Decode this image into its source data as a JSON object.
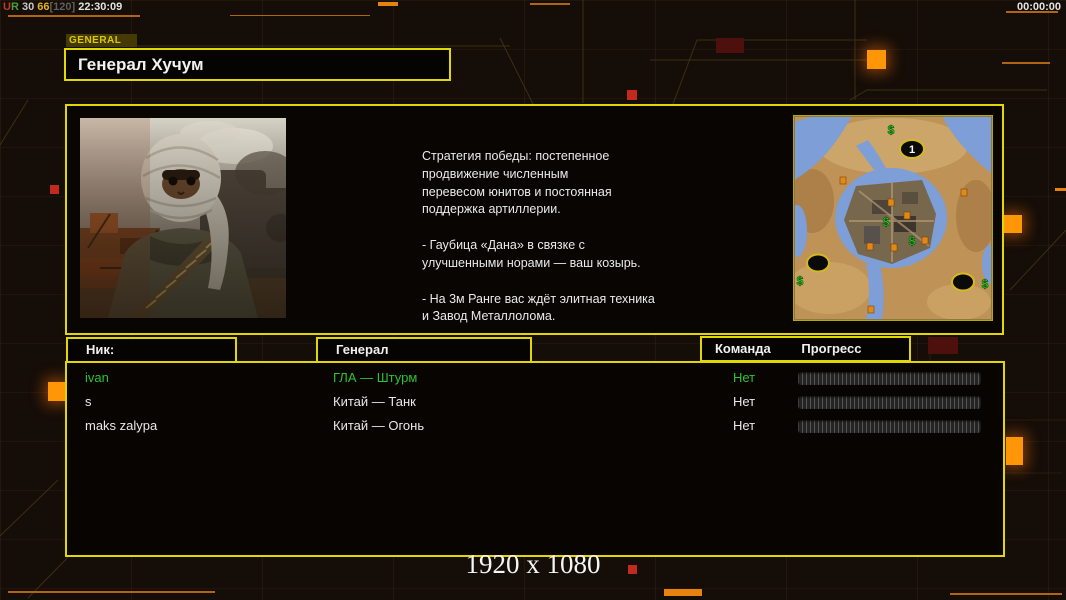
{
  "statusbar": {
    "segments": [
      {
        "text": "U",
        "color": "#c0392b"
      },
      {
        "text": "R",
        "color": "#45a035"
      },
      {
        "text": " 30 ",
        "color": "#c8c8c8"
      },
      {
        "text": "66",
        "color": "#e3b31d"
      },
      {
        "text": "[120]",
        "color": "#5f5f5f"
      },
      {
        "text": " 22:30:09",
        "color": "#e2e2e2"
      }
    ],
    "timer": "00:00:00"
  },
  "tab_label": "GENERAL",
  "title": "Генерал Хучум",
  "strategy": {
    "para1": "Стратегия победы: постепенное\nпродвижение численным\nперевесом юнитов и постоянная\nподдержка артиллерии.",
    "para2": "- Гаубица «Дана» в связке с\nулучшенными норами — ваш козырь.",
    "para3": "- На 3м Ранге вас ждёт элитная техника\nи Завод Металлолома."
  },
  "minimap": {
    "markers": [
      {
        "type": "number",
        "x": 118,
        "y": 33,
        "label": "1"
      },
      {
        "type": "start",
        "x": 24,
        "y": 147
      },
      {
        "type": "start",
        "x": 169,
        "y": 166
      },
      {
        "type": "cash",
        "x": 97,
        "y": 14
      },
      {
        "type": "cash",
        "x": 92,
        "y": 106
      },
      {
        "type": "cash",
        "x": 118,
        "y": 125
      },
      {
        "type": "cash",
        "x": 6,
        "y": 165
      },
      {
        "type": "cash",
        "x": 191,
        "y": 168
      },
      {
        "type": "oil",
        "x": 49,
        "y": 64
      },
      {
        "type": "oil",
        "x": 170,
        "y": 76
      },
      {
        "type": "oil",
        "x": 97,
        "y": 86
      },
      {
        "type": "oil",
        "x": 113,
        "y": 99
      },
      {
        "type": "oil",
        "x": 76,
        "y": 130
      },
      {
        "type": "oil",
        "x": 100,
        "y": 131
      },
      {
        "type": "oil",
        "x": 131,
        "y": 124
      },
      {
        "type": "oil",
        "x": 77,
        "y": 193
      }
    ]
  },
  "table": {
    "headers": {
      "nick": "Ник:",
      "general": "Генерал",
      "team": "Команда",
      "progress": "Прогресс"
    },
    "rows": [
      {
        "nick": "ivan",
        "general": "ГЛА — Штурм",
        "team": "Нет",
        "color": "#2fc32f",
        "progress_percent": 0
      },
      {
        "nick": "s",
        "general": "Китай — Танк",
        "team": "Нет",
        "color": "#e8e8e8",
        "progress_percent": 0
      },
      {
        "nick": "maks zalypa",
        "general": "Китай — Огонь",
        "team": "Нет",
        "color": "#e8e8e8",
        "progress_percent": 0
      }
    ]
  },
  "resolution_label": "1920 x 1080",
  "colors": {
    "accent_yellow": "#e3d703",
    "accent_orange": "#ff9608",
    "line_orange": "#b06414",
    "player_green": "#2fc32f",
    "background": "#150d08"
  }
}
